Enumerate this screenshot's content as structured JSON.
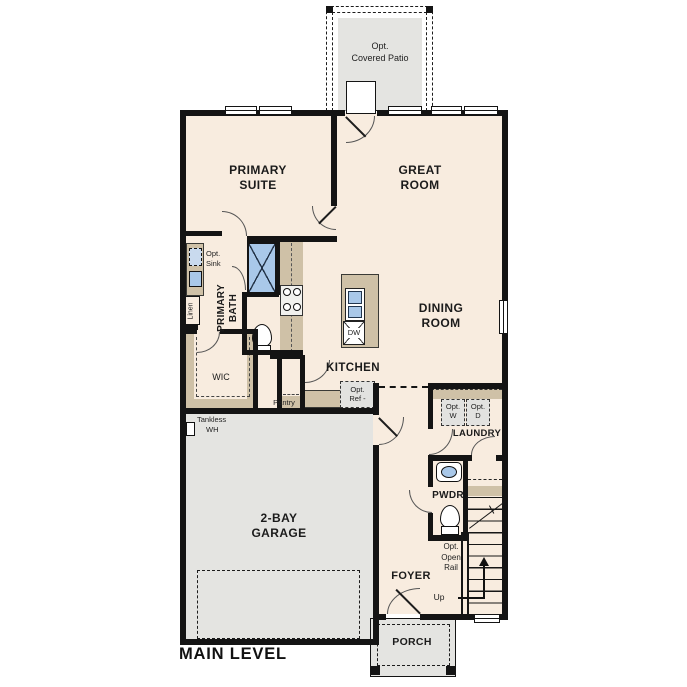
{
  "plan": {
    "title": "MAIN LEVEL",
    "colors": {
      "floor": "#f8ecdf",
      "exterior_concrete": "#e4e4e1",
      "cabinet": "#cfc1a7",
      "fixture_blue": "#a9c8e9",
      "wall": "#141414"
    },
    "labels": {
      "patio": [
        "Opt.",
        "Covered Patio"
      ],
      "primary_suite": [
        "PRIMARY",
        "SUITE"
      ],
      "great_room": [
        "GREAT",
        "ROOM"
      ],
      "dining": [
        "DINING",
        "ROOM"
      ],
      "kitchen": "KITCHEN",
      "opt_sink": [
        "Opt.",
        "Sink"
      ],
      "linen": "Linen",
      "primary_bath": [
        "PRIMARY",
        "BATH"
      ],
      "dw": "DW",
      "wic": "WIC",
      "pantry": "Pantry",
      "opt_ref": [
        "Opt.",
        "Ref -"
      ],
      "opt_w": [
        "Opt.",
        "W"
      ],
      "opt_d": [
        "Opt.",
        "D"
      ],
      "laundry": "LAUNDRY",
      "tankless": [
        "Tankless",
        "WH"
      ],
      "garage": [
        "2-BAY",
        "GARAGE"
      ],
      "pwdr": "PWDR",
      "open_rail": [
        "Opt.",
        "Open",
        "Rail"
      ],
      "up": "Up",
      "foyer": "FOYER",
      "porch": "PORCH"
    }
  }
}
